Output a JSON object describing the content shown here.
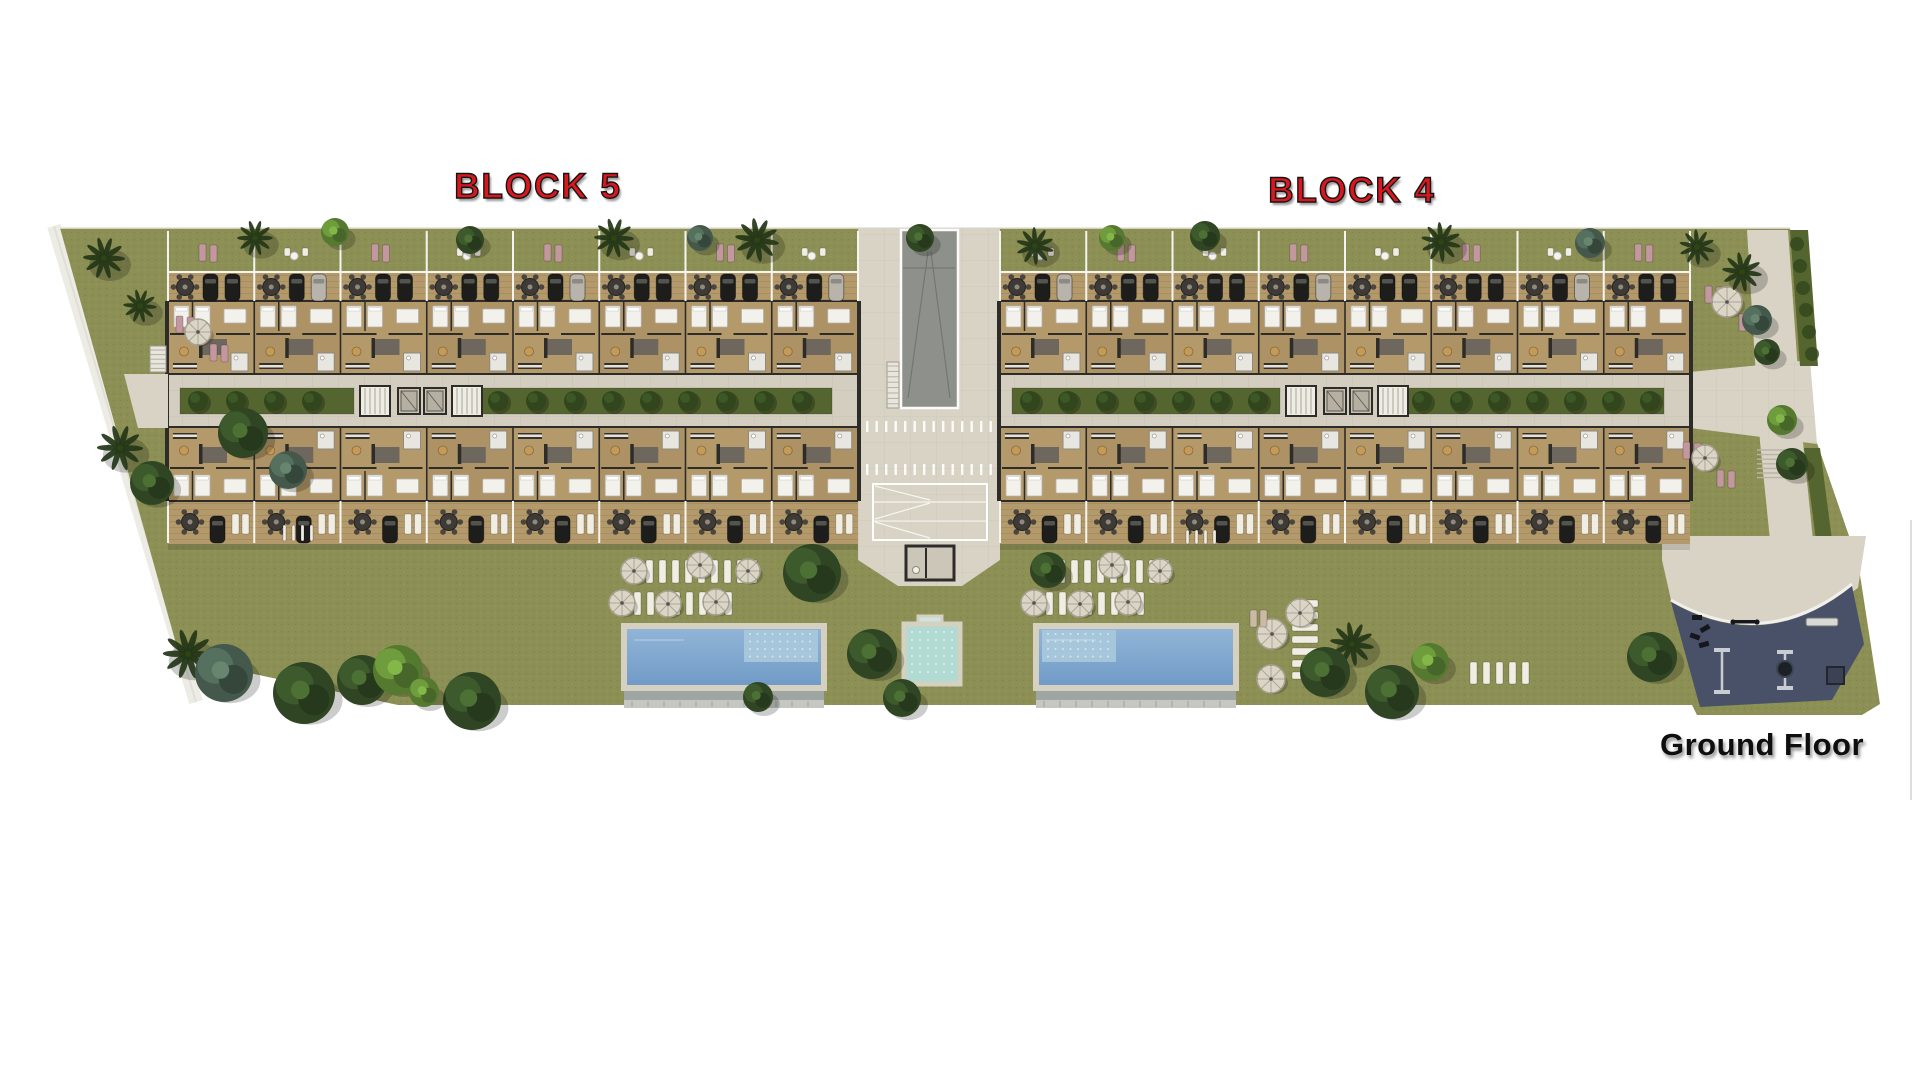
{
  "canvas": {
    "width": 1920,
    "height": 1080,
    "background": "#ffffff"
  },
  "labels": {
    "block_left": "BLOCK 5",
    "block_right": "BLOCK 4",
    "floor": "Ground Floor"
  },
  "site": {
    "block_count": 2,
    "units_per_row": 8,
    "rows_per_block": 2,
    "lap_pool_count": 2,
    "kids_pool_count": 1,
    "outdoor_gym_count": 1
  },
  "palette": {
    "label_red": "#d8171e",
    "label_outline": "#161413",
    "label_dark": "#0e0e0e",
    "lawn": "#8c9055",
    "hedge": "#55652f",
    "hedge_tree": "#31461d",
    "path": "#ecebe4",
    "plaza": "#d8d3c5",
    "corridor": "#d4cec0",
    "road": "#8e908b",
    "wood": "#b49a6b",
    "floor_a": "#b49a6b",
    "floor_b": "#ac9265",
    "wall": "#2e2c29",
    "pool_deep": "#6f9ac6",
    "pool_light": "#93b6d8",
    "pool_shallow": "#a9c9dc",
    "pool_border": "#d6d0c0",
    "pool_edge": "#9fa5a3",
    "kids_pool": "#b0dad2",
    "gym": "#485168",
    "gym_equipment": "#15171d",
    "white_furniture": "#f0ede3",
    "pink_lounger": "#c2989e",
    "umbrella": "#dbd5c5",
    "tree_dark": "#2f4523",
    "tree_green": "#6f9c3c",
    "tree_blue": "#56705f",
    "palm": "#233617",
    "car_dark": "#1d1d1b",
    "car_light": "#b8b4ab"
  }
}
